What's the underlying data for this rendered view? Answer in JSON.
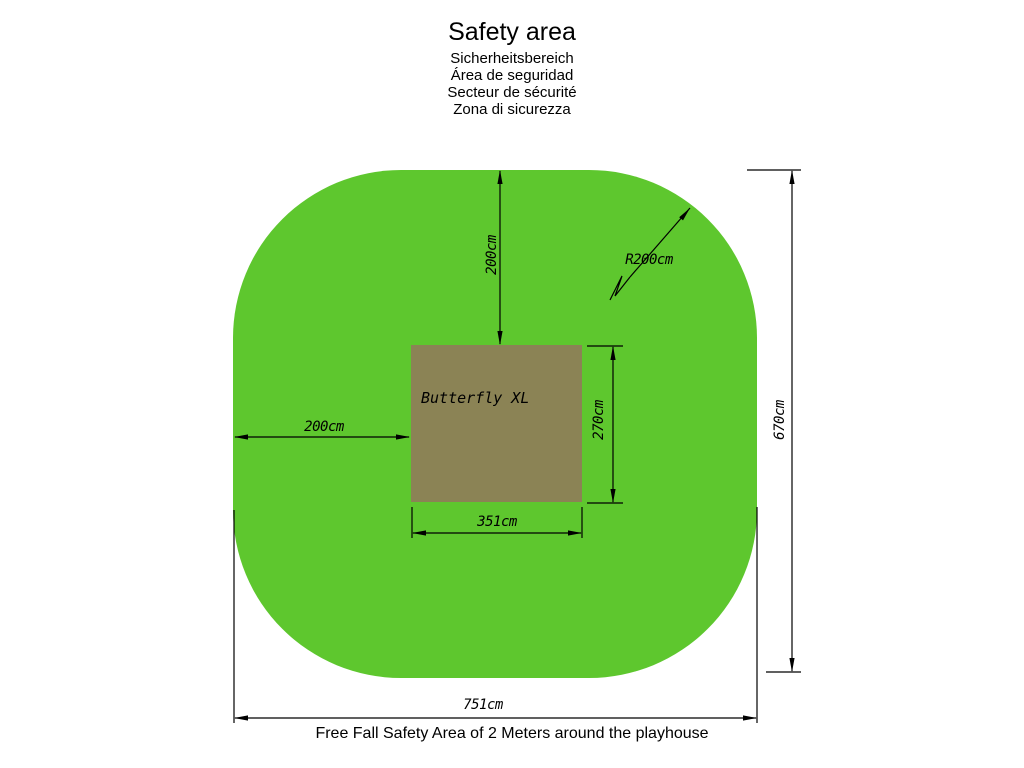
{
  "title": {
    "main": "Safety area",
    "translations": [
      "Sicherheitsbereich",
      "Área de seguridad",
      "Secteur de sécurité",
      "Zona di sicurezza"
    ]
  },
  "playhouse": {
    "label": "Butterfly XL"
  },
  "dimensions": {
    "top_clearance": "200cm",
    "left_clearance": "200cm",
    "corner_radius": "R200cm",
    "playhouse_depth": "270cm",
    "playhouse_width": "351cm",
    "overall_depth": "670cm",
    "overall_width": "751cm"
  },
  "colors": {
    "safety_area_green": "#5ec72e",
    "playhouse_brown": "#8b8355"
  },
  "footer": {
    "caption": "Free Fall Safety Area of 2 Meters around the playhouse"
  }
}
